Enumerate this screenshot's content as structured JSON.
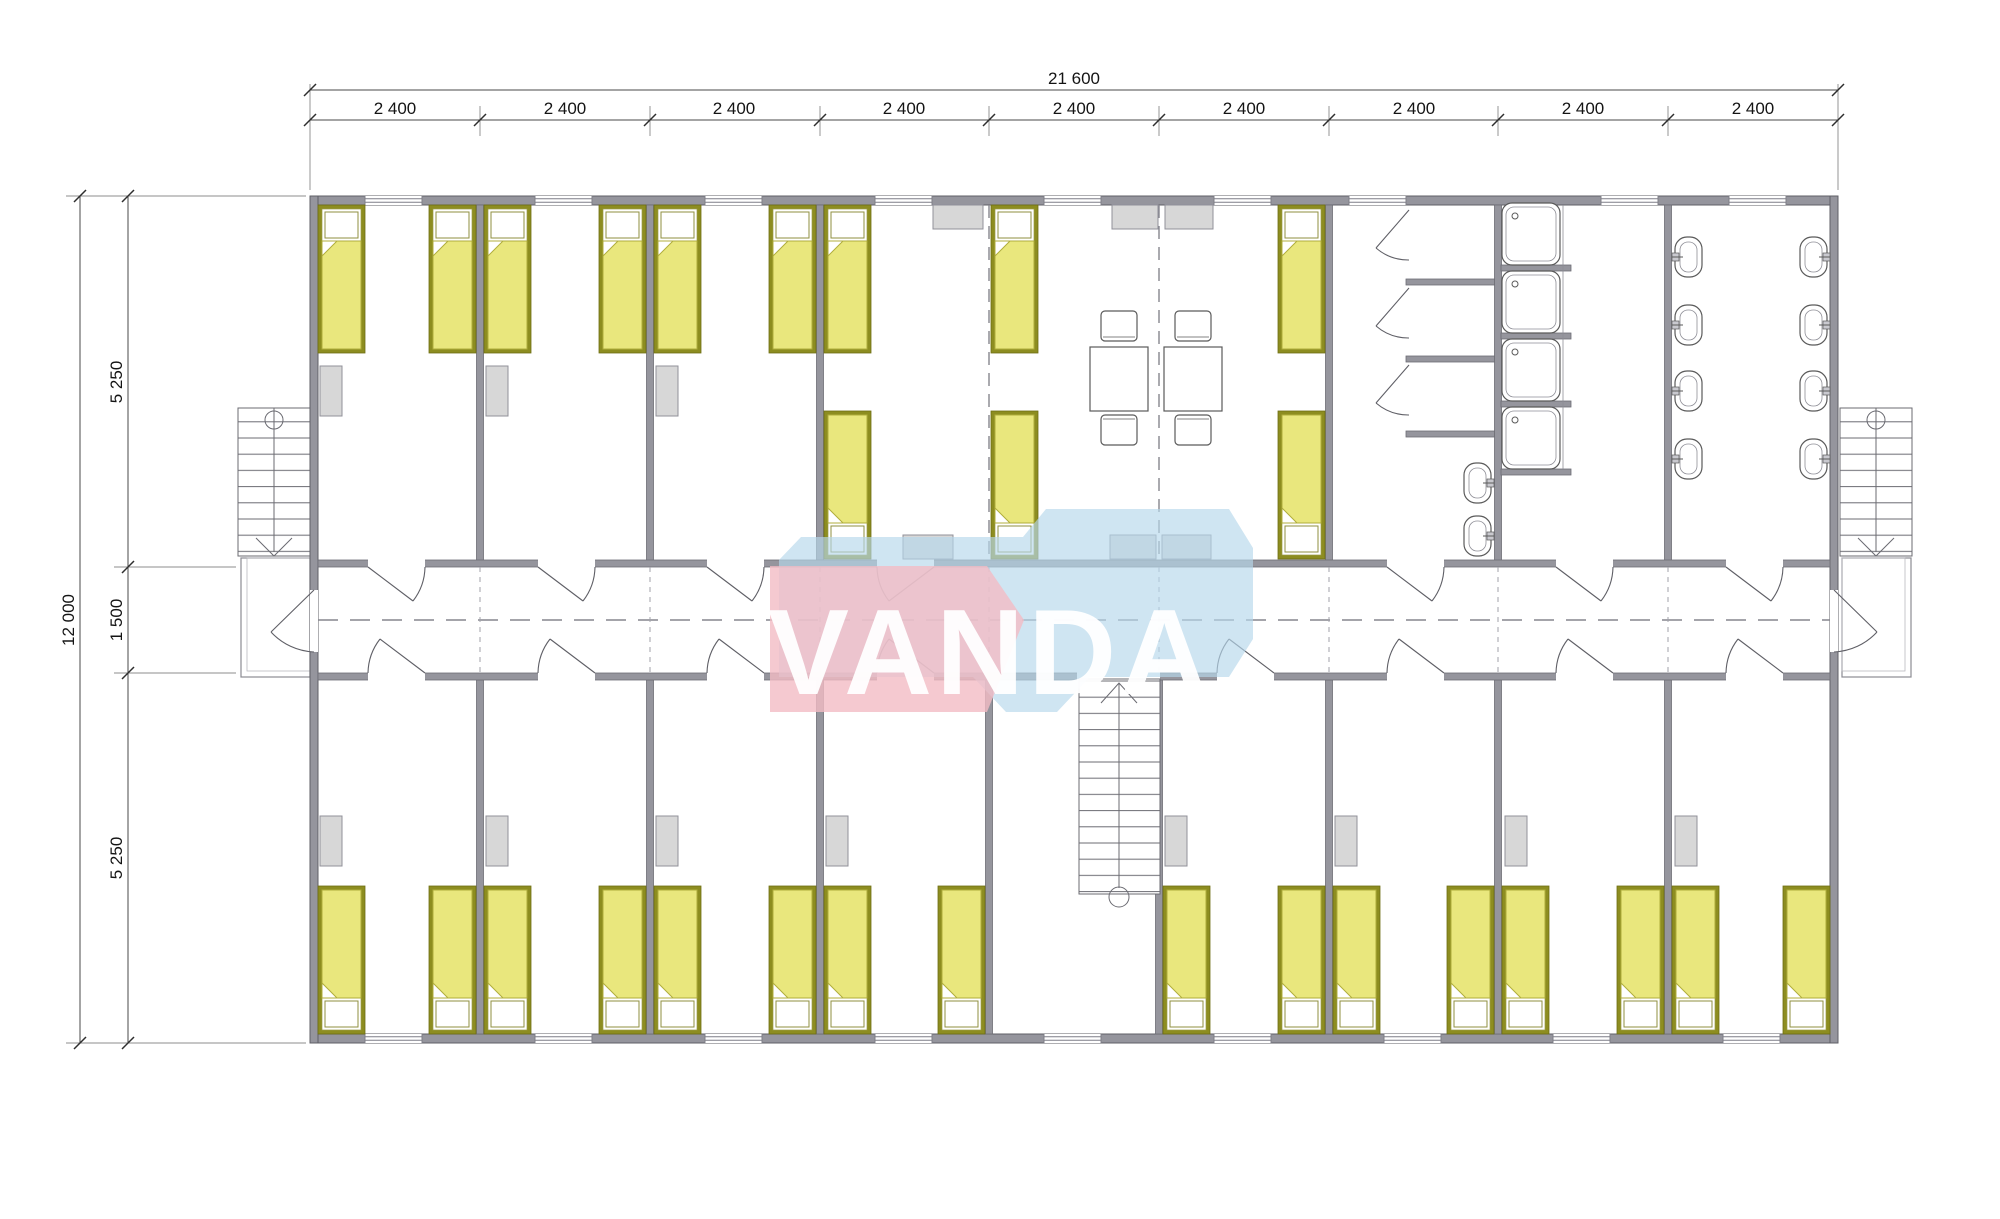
{
  "watermark": {
    "text": "VANDA"
  },
  "dimensions": {
    "overall_width": "21 600",
    "module_widths": [
      "2 400",
      "2 400",
      "2 400",
      "2 400",
      "2 400",
      "2 400",
      "2 400",
      "2 400",
      "2 400"
    ],
    "overall_height": "12 000",
    "upper_rooms_depth": "5 250",
    "corridor_width": "1 500",
    "lower_rooms_depth": "5 250"
  },
  "colors": {
    "wall": "#95959d",
    "bed_frame": "#8d8d20",
    "bed_blanket": "#e9e77d",
    "furniture_fill": "#d7d7d7",
    "fixture_line": "#5a5a5a",
    "logo_pink": "#f2bcc4",
    "logo_blue": "#b6d8ec",
    "dimension_text": "#141414"
  }
}
